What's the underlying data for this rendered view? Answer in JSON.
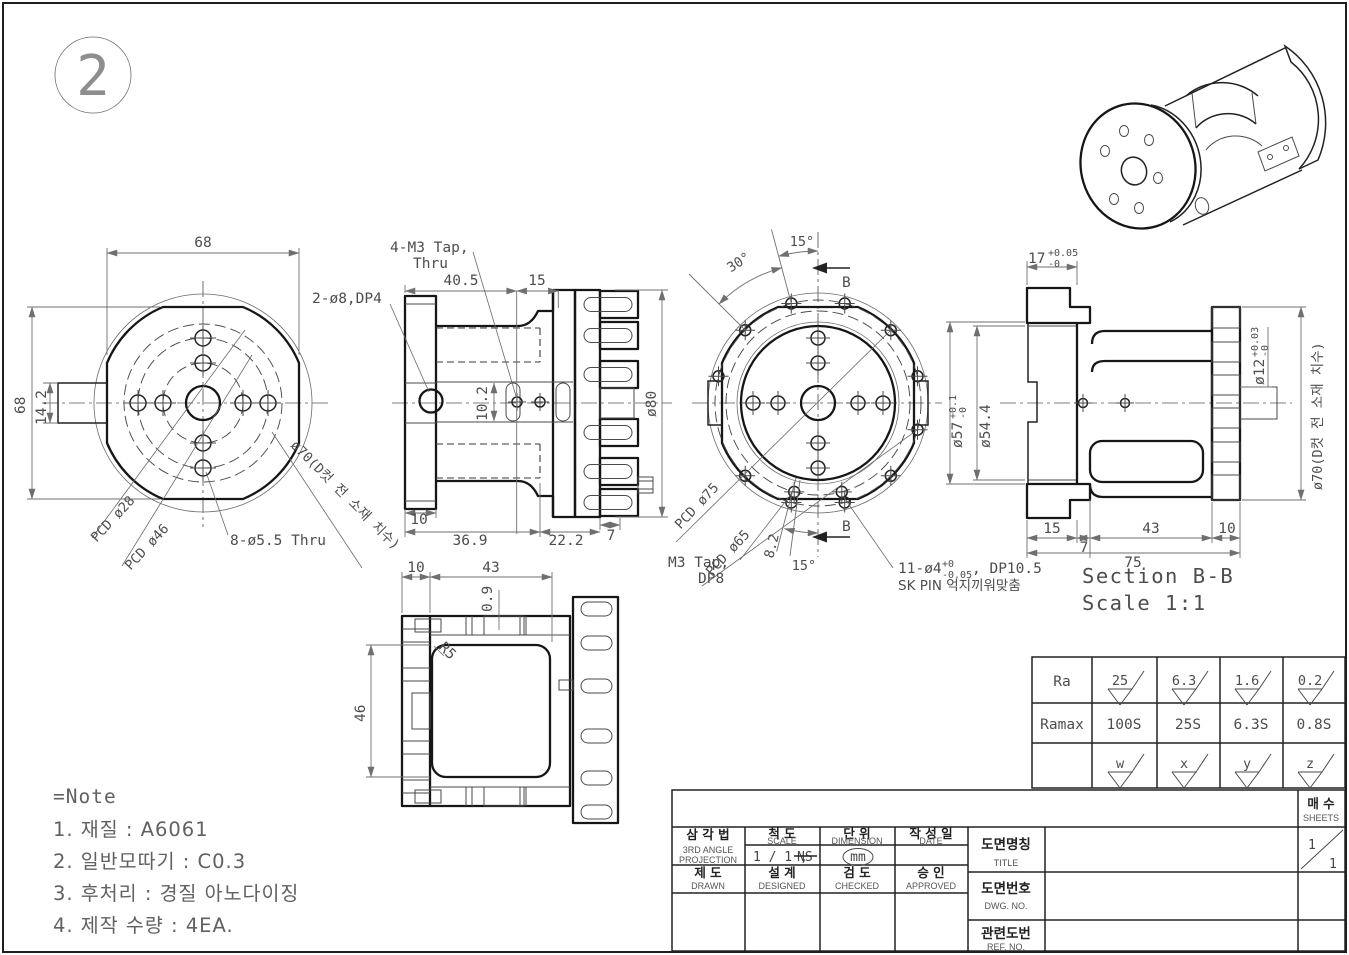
{
  "balloon": {
    "number": "2"
  },
  "left_view": {
    "dim_width": "68",
    "dim_height": "68",
    "dim_tab": "14.2",
    "label_pcd28": "PCD ø28",
    "label_pcd46": "PCD ø46",
    "label_holes_thru": "8-ø5.5 Thru",
    "label_dcut": "ø70(D컷 전 소재 치수)"
  },
  "front_view": {
    "label_holes_top": "2-ø8,DP4",
    "label_tap_line1": "4-M3 Tap,",
    "label_tap_line2": "Thru",
    "dim_40_5": "40.5",
    "dim_15": "15",
    "dim_10_2": "10.2",
    "dim_dia80": "ø80",
    "dim_10": "10",
    "dim_36_9": "36.9",
    "dim_22_2": "22.2",
    "dim_7": "7"
  },
  "right_view": {
    "dim_angle30": "30°",
    "dim_angle15_top": "15°",
    "section_arrow_top": "B",
    "section_arrow_bottom": "B",
    "label_pcd75": "PCD ø75",
    "label_pcd65": "PCD ø65",
    "label_m3_line1": "M3 Tap,",
    "label_m3_line2": "DP8",
    "dim_8_2": "8.2",
    "dim_angle15_bottom": "15°",
    "label_pin_main": "11-ø4",
    "label_pin_tol_up": "+0",
    "label_pin_tol_dn": "-0.05",
    "label_pin_rest": ", DP10.5",
    "label_pin_line2": "SK PIN 억지끼워맞춤"
  },
  "section_view": {
    "dim_17": "17",
    "dim_17_up": "+0.05",
    "dim_17_dn": "-0",
    "dim_d57": "ø57",
    "dim_d57_up": "+0.1",
    "dim_d57_dn": "-0",
    "dim_d54_4": "ø54.4",
    "dim_d12": "ø12",
    "dim_d12_up": "+0.03",
    "dim_d12_dn": "-0",
    "label_d70": "ø70(D컷 전 소재 치수)",
    "dim_15": "15",
    "dim_7": "7",
    "dim_43": "43",
    "dim_10": "10",
    "dim_75": "75",
    "title": "Section B-B",
    "scale": "Scale 1:1"
  },
  "bottom_view": {
    "dim_10": "10",
    "dim_43": "43",
    "dim_0_9": "0.9",
    "label_r5": "R5",
    "dim_46": "46"
  },
  "notes": {
    "title": "=Note",
    "items": [
      "1. 재질 : A6061",
      "2. 일반모따기 : C0.3",
      "3. 후처리 : 경질 아노다이징",
      "4. 제작 수량 : 4EA."
    ]
  },
  "roughness": {
    "ra_label": "Ra",
    "ramax_label": "Ramax",
    "ra": [
      "25",
      "6.3",
      "1.6",
      "0.2"
    ],
    "ramax": [
      "100S",
      "25S",
      "6.3S",
      "0.8S"
    ],
    "grades": [
      "w",
      "x",
      "y",
      "z"
    ]
  },
  "title_block": {
    "projection_kr": "삼  각  법",
    "projection_en_1": "3RD ANGLE",
    "projection_en_2": "PROJECTION",
    "scale_kr": "척    도",
    "scale_en": "SCALE",
    "scale_value": "1 / 1 ,",
    "scale_ns": "NS",
    "unit_kr": "단    위",
    "unit_en": "DIMENSION",
    "unit_value": "mm",
    "date_kr": "작 성 일",
    "date_en": "DATE",
    "drawn_kr": "제    도",
    "drawn_en": "DRAWN",
    "designed_kr": "설    계",
    "designed_en": "DESIGNED",
    "checked_kr": "검    도",
    "checked_en": "CHECKED",
    "approved_kr": "승    인",
    "approved_en": "APPROVED",
    "title_kr": "도면명칭",
    "title_en": "TITLE",
    "dwg_kr": "도면번호",
    "dwg_en": "DWG. NO.",
    "ref_kr": "관련도번",
    "ref_en": "REF. NO.",
    "sheets_kr": "매 수",
    "sheets_en": "SHEETS",
    "sheets_top": "1",
    "sheets_bottom": "1"
  }
}
